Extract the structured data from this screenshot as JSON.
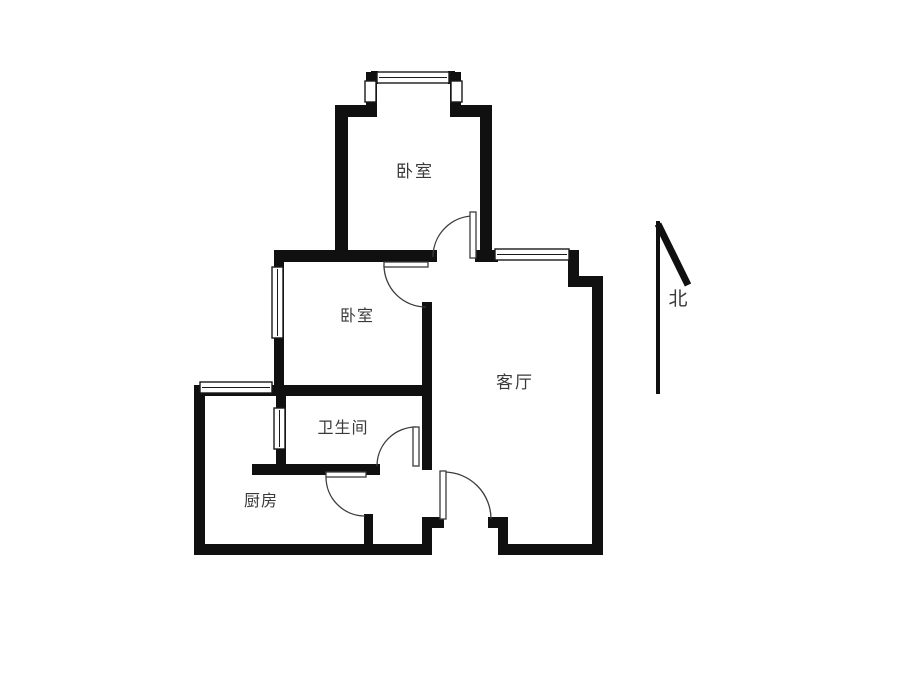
{
  "floor_plan": {
    "rooms": [
      {
        "id": "bedroom-north",
        "label": "卧室"
      },
      {
        "id": "bedroom-middle",
        "label": "卧室"
      },
      {
        "id": "living-room",
        "label": "客厅"
      },
      {
        "id": "bathroom",
        "label": "卫生间"
      },
      {
        "id": "kitchen",
        "label": "厨房"
      }
    ],
    "compass": {
      "label": "北"
    }
  },
  "colors": {
    "wall": "#101010",
    "window_stroke": "#1a1a1a",
    "door": "#3c3c3c",
    "label": "#3a3a3a",
    "background": "#ffffff"
  }
}
